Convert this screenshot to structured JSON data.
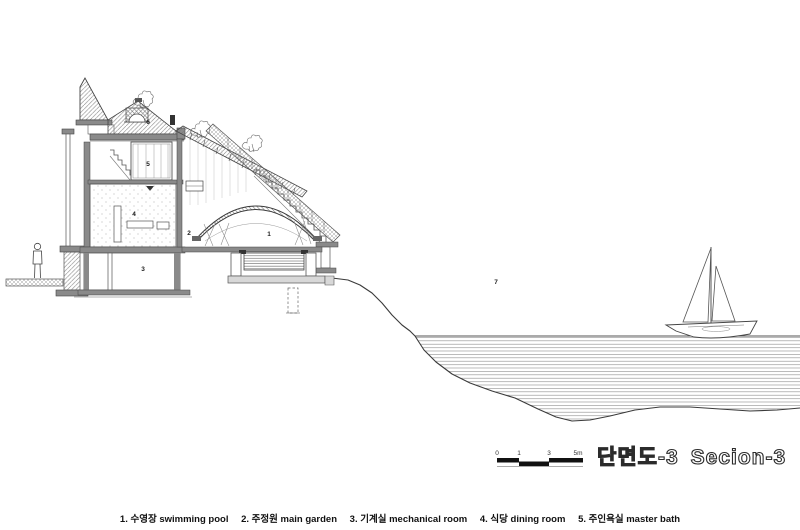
{
  "page": {
    "background": "#ffffff"
  },
  "title": {
    "korean": "단면도-3",
    "english": "Secion-3"
  },
  "scale_bar": {
    "ticks": [
      "0",
      "1",
      "3",
      "5m"
    ]
  },
  "legend": {
    "items": [
      {
        "text": "1. 수영장 swimming pool"
      },
      {
        "text": "2. 주정원 main garden"
      },
      {
        "text": "3. 기계실 mechanical room"
      },
      {
        "text": "4. 식당 dining room"
      },
      {
        "text": "5. 주인욕실 master bath"
      }
    ]
  },
  "drawing": {
    "type": "architectural-section",
    "labels": [
      {
        "n": "1",
        "name": "swimming pool"
      },
      {
        "n": "2",
        "name": "main garden"
      },
      {
        "n": "3",
        "name": "mechanical room"
      },
      {
        "n": "4",
        "name": "dining room"
      },
      {
        "n": "5",
        "name": "master bath"
      },
      {
        "n": "6",
        "name": ""
      },
      {
        "n": "7",
        "name": ""
      }
    ],
    "colors": {
      "line": "#2b2b2b",
      "hatch": "#777777",
      "poche": "#8a8a8a",
      "water": "#8a8a8a"
    }
  }
}
